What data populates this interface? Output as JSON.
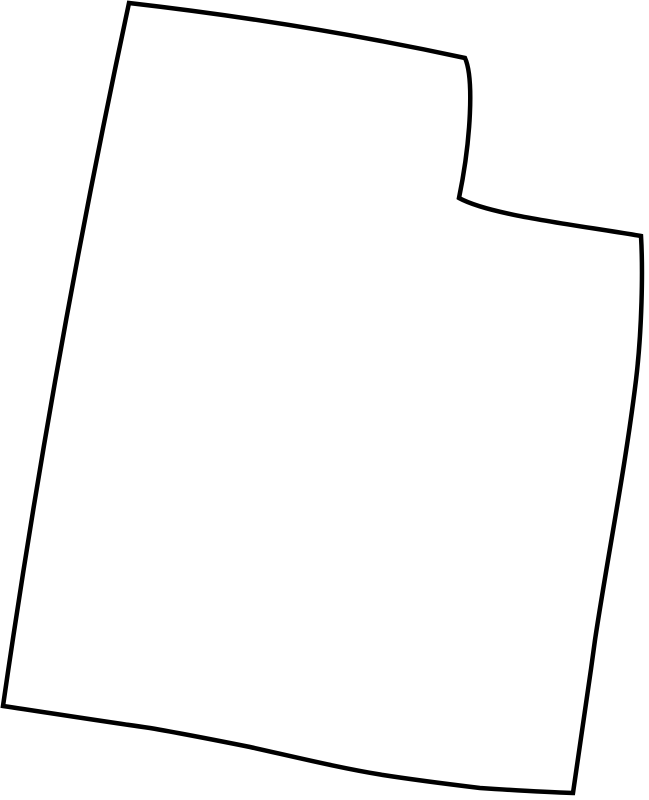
{
  "page": {
    "background_color": "#ffffff"
  },
  "map": {
    "name": "Utah state outline",
    "viewbox": "0 0 649 800",
    "stroke_color": "#000000",
    "fill_color": "none",
    "stroke_width": "4.5",
    "path_d": "M 129,3 Q 303,23 465,58 C 474,78 471,140 459,198 C 490,215 570,224 641,236 C 643,270 642,330 636,380 C 625,470 607,560 595,640 C 588,692 580,745 573,793 C 540,792 510,790 480,788 C 447,784 415,780 383,775 C 340,768 295,757 250,747 C 215,740 185,734 150,728 C 100,721 50,713 3,706 Q 54,353 129,3 Z"
  }
}
